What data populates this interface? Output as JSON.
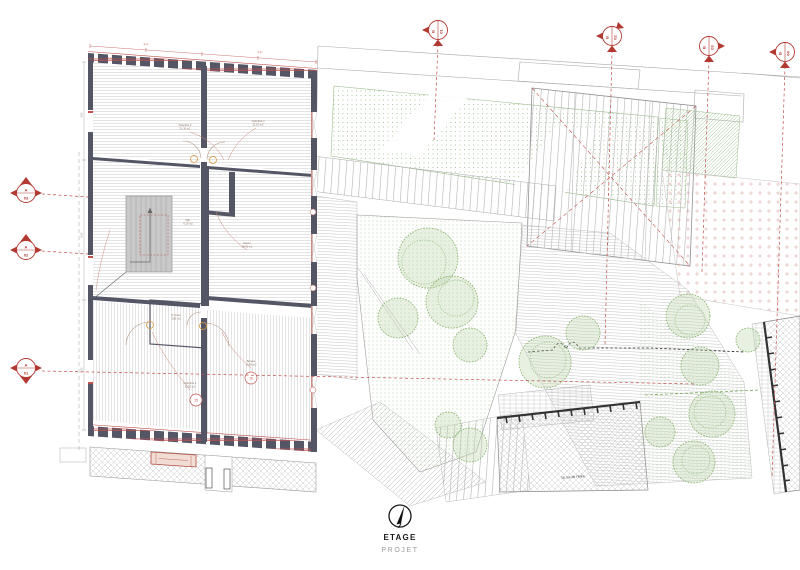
{
  "title_block": {
    "level": "ETAGE",
    "phase": "PROJET"
  },
  "north": {
    "icon": "north-arrow"
  },
  "section_markers": {
    "left": [
      {
        "letter": "A",
        "number": "03"
      },
      {
        "letter": "A",
        "number": "02"
      },
      {
        "letter": "A",
        "number": "01"
      }
    ],
    "top": [
      {
        "letter": "B",
        "number": "01"
      },
      {
        "letter": "B",
        "number": "02"
      },
      {
        "letter": "B",
        "number": "03"
      },
      {
        "letter": "B",
        "number": "04"
      }
    ]
  },
  "plan": {
    "rooms": [
      {
        "name": "Chambre 2",
        "area": "21,30 m2"
      },
      {
        "name": "Chambre 3",
        "area": "21,10 m2"
      },
      {
        "name": "Sejour",
        "area": "28,45 m2"
      },
      {
        "name": "Dgt.",
        "area": "6,10 m2"
      },
      {
        "name": "S. d'eau",
        "area": "3,85 m2"
      },
      {
        "name": "Chambre 1",
        "area": "20,15 m2"
      },
      {
        "name": "Bureau",
        "area": "19,90 m2"
      }
    ],
    "tags": [
      "15",
      "16"
    ],
    "dimensions": [
      "5,44",
      "5,37",
      "4,90",
      "6,50",
      "5,90",
      "2,28",
      "0,90"
    ]
  },
  "site": {
    "street_label": "16 rue de l'Italie"
  },
  "colors": {
    "accent_red": "#b23a32",
    "dim_red": "#c0504d",
    "wall": "#545666",
    "vegetation_green": "#93bf80",
    "hardware_orange": "#d9973f"
  }
}
